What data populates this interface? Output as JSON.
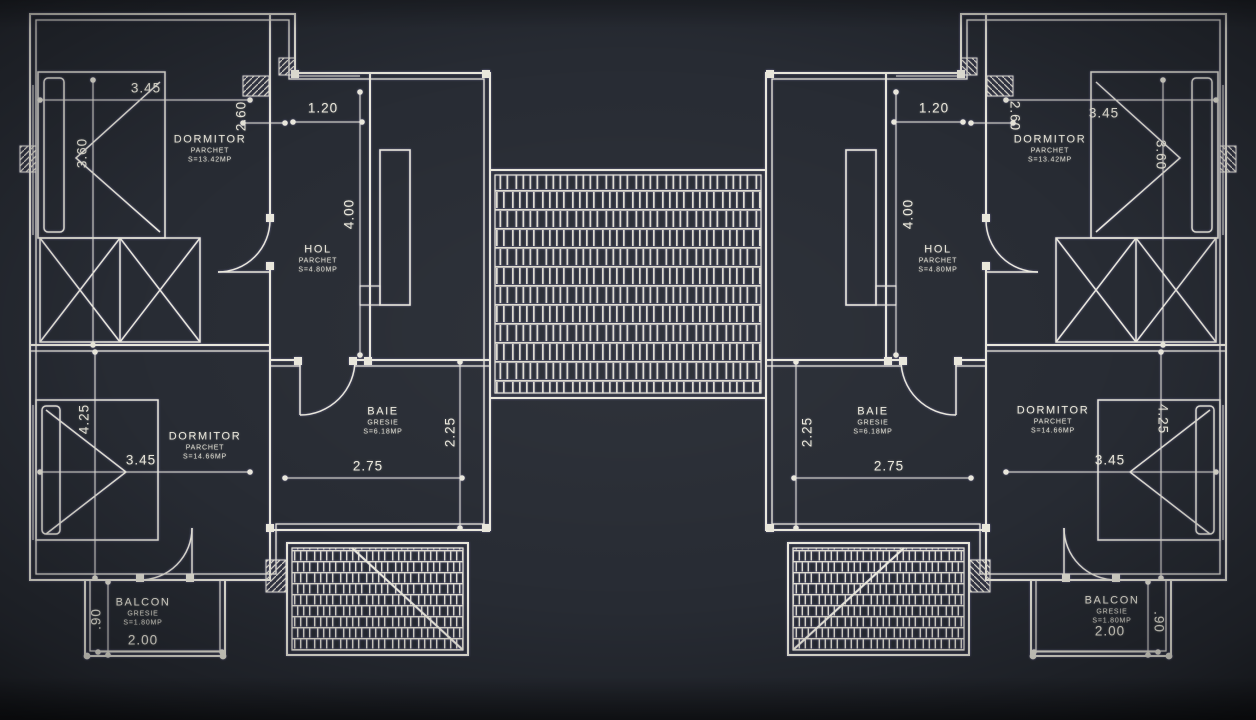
{
  "canvas": {
    "background_color": "#272b33",
    "line_color": "#e9e7dc",
    "drawing_type": "floor plan - two mirrored apartment units"
  },
  "units": {
    "left": {
      "rooms": {
        "dormitor_top": {
          "name": "DORMITOR",
          "finish": "PARCHET",
          "area": "S=13.42MP"
        },
        "hol": {
          "name": "HOL",
          "finish": "PARCHET",
          "area": "S=4.80MP"
        },
        "baie": {
          "name": "BAIE",
          "finish": "GRESIE",
          "area": "S=6.18MP"
        },
        "dormitor_bottom": {
          "name": "DORMITOR",
          "finish": "PARCHET",
          "area": "S=14.66MP"
        },
        "balcon": {
          "name": "BALCON",
          "finish": "GRESIE",
          "area": "S=1.80MP"
        }
      },
      "dims": {
        "room_top_width": "3.45",
        "hall_recess": "2.60",
        "entry_window": "1.20",
        "hall_depth": "4.00",
        "room_top_depth": "3.60",
        "room_bottom_depth": "4.25",
        "room_bottom_width": "3.45",
        "bath_width": "2.75",
        "bath_depth": "2.25",
        "balcony_depth": ".90",
        "balcony_width": "2.00"
      }
    },
    "right": {
      "rooms": {
        "dormitor_top": {
          "name": "DORMITOR",
          "finish": "PARCHET",
          "area": "S=13.42MP"
        },
        "hol": {
          "name": "HOL",
          "finish": "PARCHET",
          "area": "S=4.80MP"
        },
        "baie": {
          "name": "BAIE",
          "finish": "GRESIE",
          "area": "S=6.18MP"
        },
        "dormitor_bottom": {
          "name": "DORMITOR",
          "finish": "PARCHET",
          "area": "S=14.66MP"
        },
        "balcon": {
          "name": "BALCON",
          "finish": "GRESIE",
          "area": "S=1.80MP"
        }
      },
      "dims": {
        "room_top_width": "3.45",
        "hall_recess": "2.60",
        "entry_window": "1.20",
        "hall_depth": "4.00",
        "room_top_depth": "3.60",
        "room_bottom_depth": "4.25",
        "room_bottom_width": "3.45",
        "bath_width": "2.75",
        "bath_depth": "2.25",
        "balcony_depth": ".90",
        "balcony_width": "2.00"
      }
    }
  }
}
